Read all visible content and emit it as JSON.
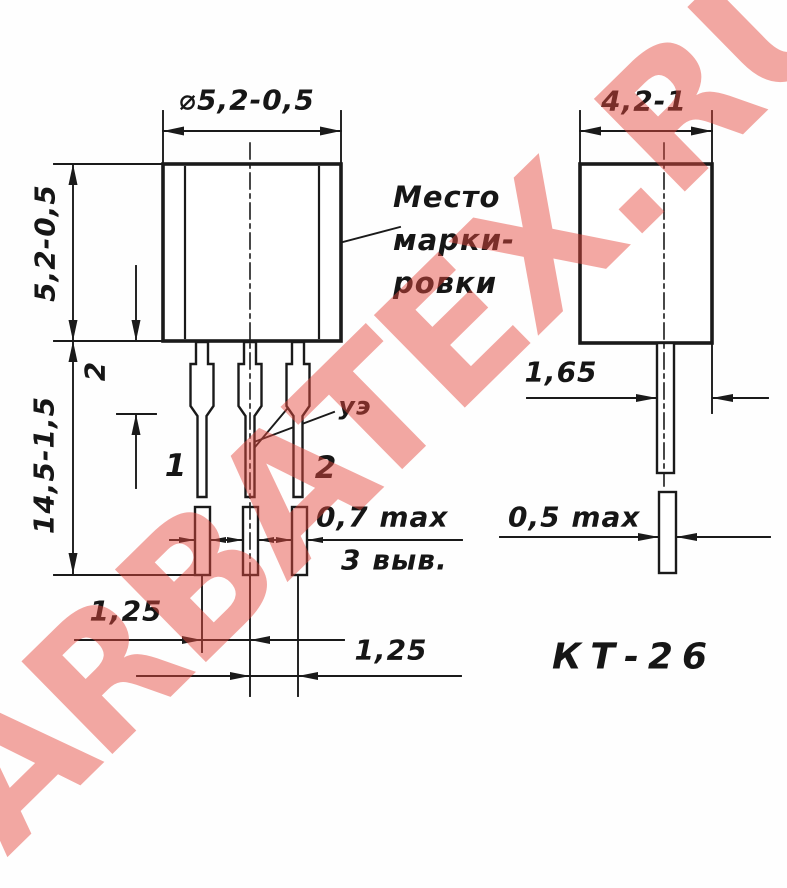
{
  "watermark": {
    "text": "ARBATEX.RU"
  },
  "package": {
    "name": "КТ-26"
  },
  "front_view": {
    "dims": {
      "diameter": "⌀5,2-0,5",
      "body_height": "5,2-0,5",
      "total_length": "14,5-1,5",
      "shoulder_length": "2",
      "lead_pitch_left": "1,25",
      "lead_pitch_right": "1,25",
      "lead_thickness": "0,7 max"
    },
    "labels": {
      "leads_note": "3 выв.",
      "marking_area": [
        "Место",
        "марки-",
        "ровки"
      ],
      "lead_1": "1",
      "lead_2": "2",
      "middle_lead": "уэ"
    }
  },
  "side_view": {
    "dims": {
      "body_depth": "4,2-1",
      "lead_offset": "1,65",
      "lead_width": "0,5 max"
    }
  }
}
